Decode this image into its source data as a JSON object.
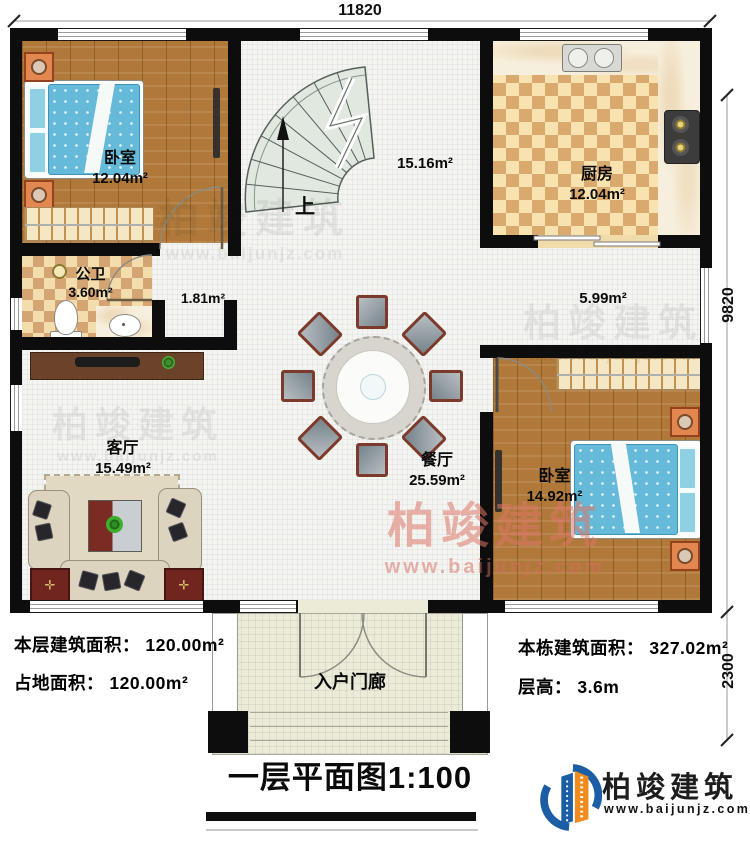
{
  "plan": {
    "title": "一层平面图1:100",
    "dimensions": {
      "top": "11820",
      "right_upper": "9820",
      "right_lower": "2300"
    },
    "stairs_label": "上",
    "rooms": {
      "bedroom1": {
        "name": "卧室",
        "area": "12.04m²"
      },
      "stair_hall": {
        "area": "15.16m²"
      },
      "kitchen": {
        "name": "厨房",
        "area": "12.04m²"
      },
      "bathroom": {
        "name": "公卫",
        "area": "3.60m²"
      },
      "corridor_small": {
        "area": "1.81m²"
      },
      "corridor_right": {
        "area": "5.99m²"
      },
      "dining": {
        "name": "餐厅",
        "area": "25.59m²"
      },
      "bedroom2": {
        "name": "卧室",
        "area": "14.92m²"
      },
      "living": {
        "name": "客厅",
        "area": "15.49m²"
      },
      "porch": {
        "name": "入户门廊"
      }
    }
  },
  "info": {
    "left": [
      "本层建筑面积： 120.00m²",
      "占地面积： 120.00m²"
    ],
    "right": [
      "本栋建筑面积： 327.02m²",
      "层高： 3.6m"
    ]
  },
  "branding": {
    "logo_name": "柏竣建筑",
    "logo_url": "www.baijunjz.com",
    "watermark_name": "柏竣建筑",
    "watermark_url": "www.baijunjz.com"
  },
  "colors": {
    "wall_black": "#0d0d0d",
    "wood_floor": "#b0793a",
    "mattress_blue": "#64bad8",
    "kitchen_tile": "#d9a96e",
    "logo_blue": "#1b5ea6",
    "logo_orange": "#f08c1e",
    "watermark_pink": "#de7668"
  }
}
